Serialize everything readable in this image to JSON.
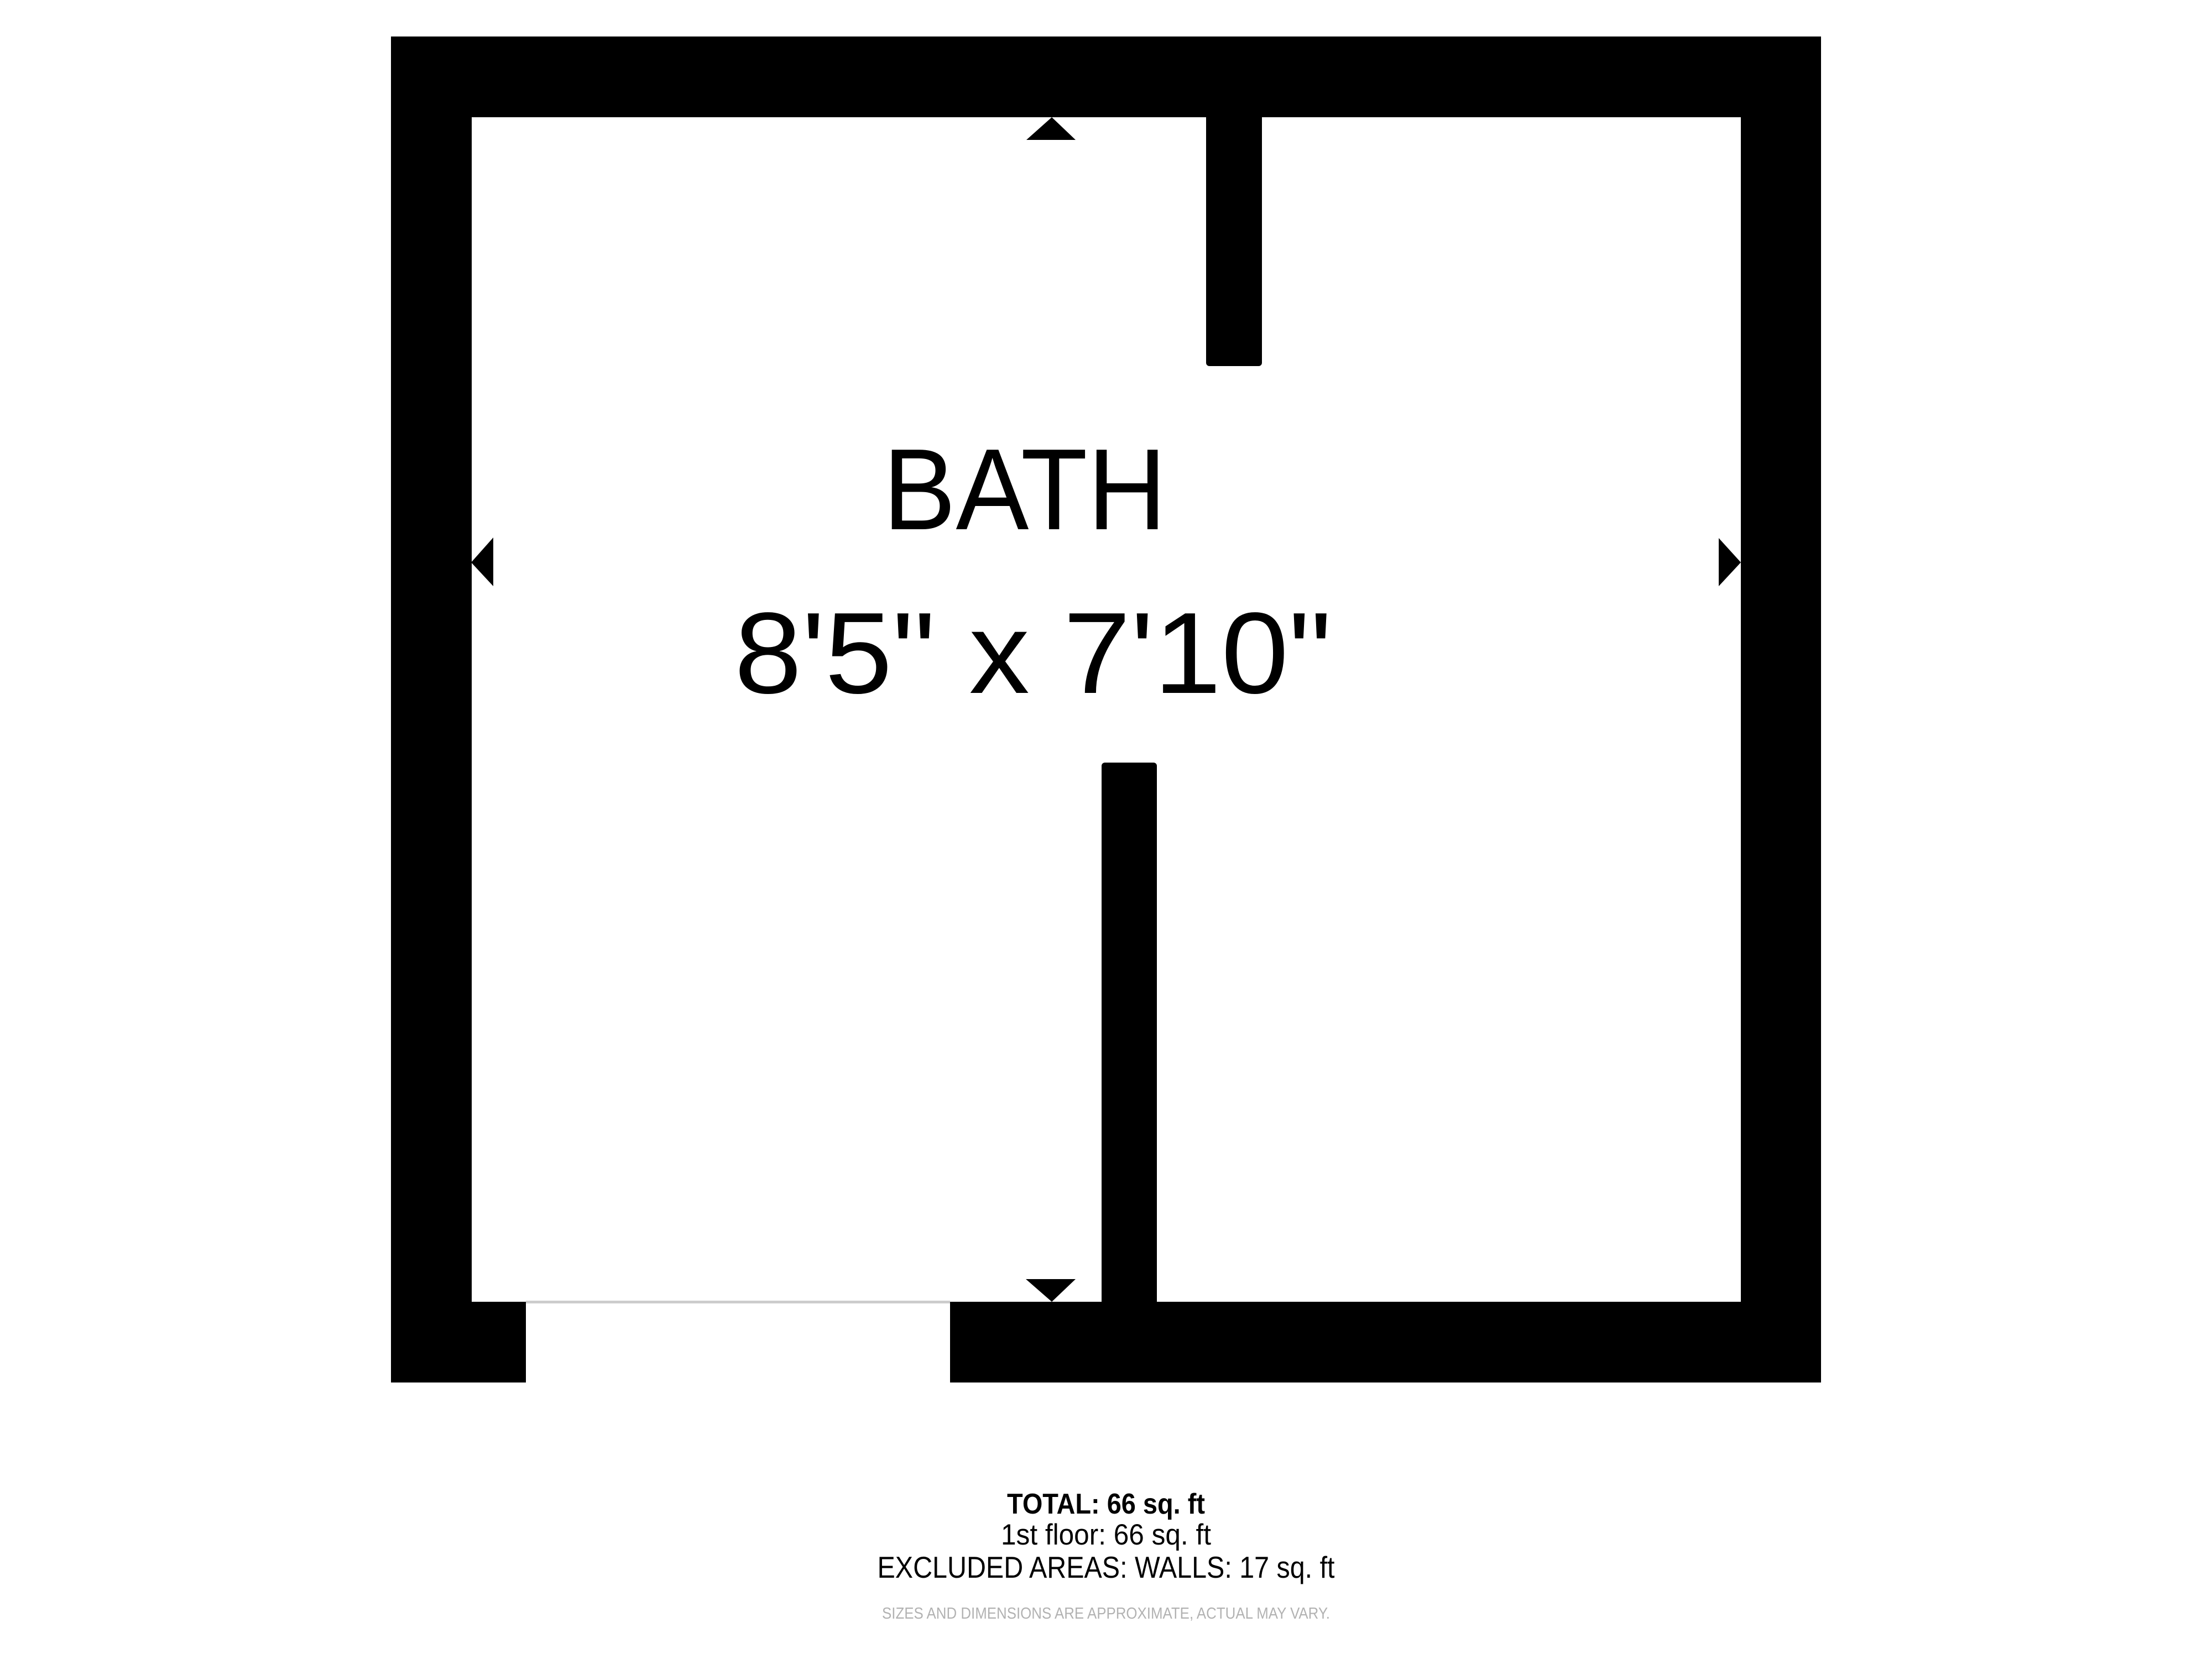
{
  "floor_plan": {
    "room": {
      "name": "BATH",
      "dimensions": "8'5\" x 7'10\""
    },
    "summary": {
      "total": "TOTAL: 66 sq. ft",
      "first_floor": "1st floor: 66 sq. ft",
      "excluded": "EXCLUDED AREAS: WALLS: 17 sq. ft",
      "disclaimer": "SIZES AND DIMENSIONS ARE APPROXIMATE, ACTUAL MAY VARY."
    },
    "colors": {
      "wall": "#000000",
      "door_line": "#cccccc",
      "disclaimer_text": "#b2b2b2"
    }
  }
}
